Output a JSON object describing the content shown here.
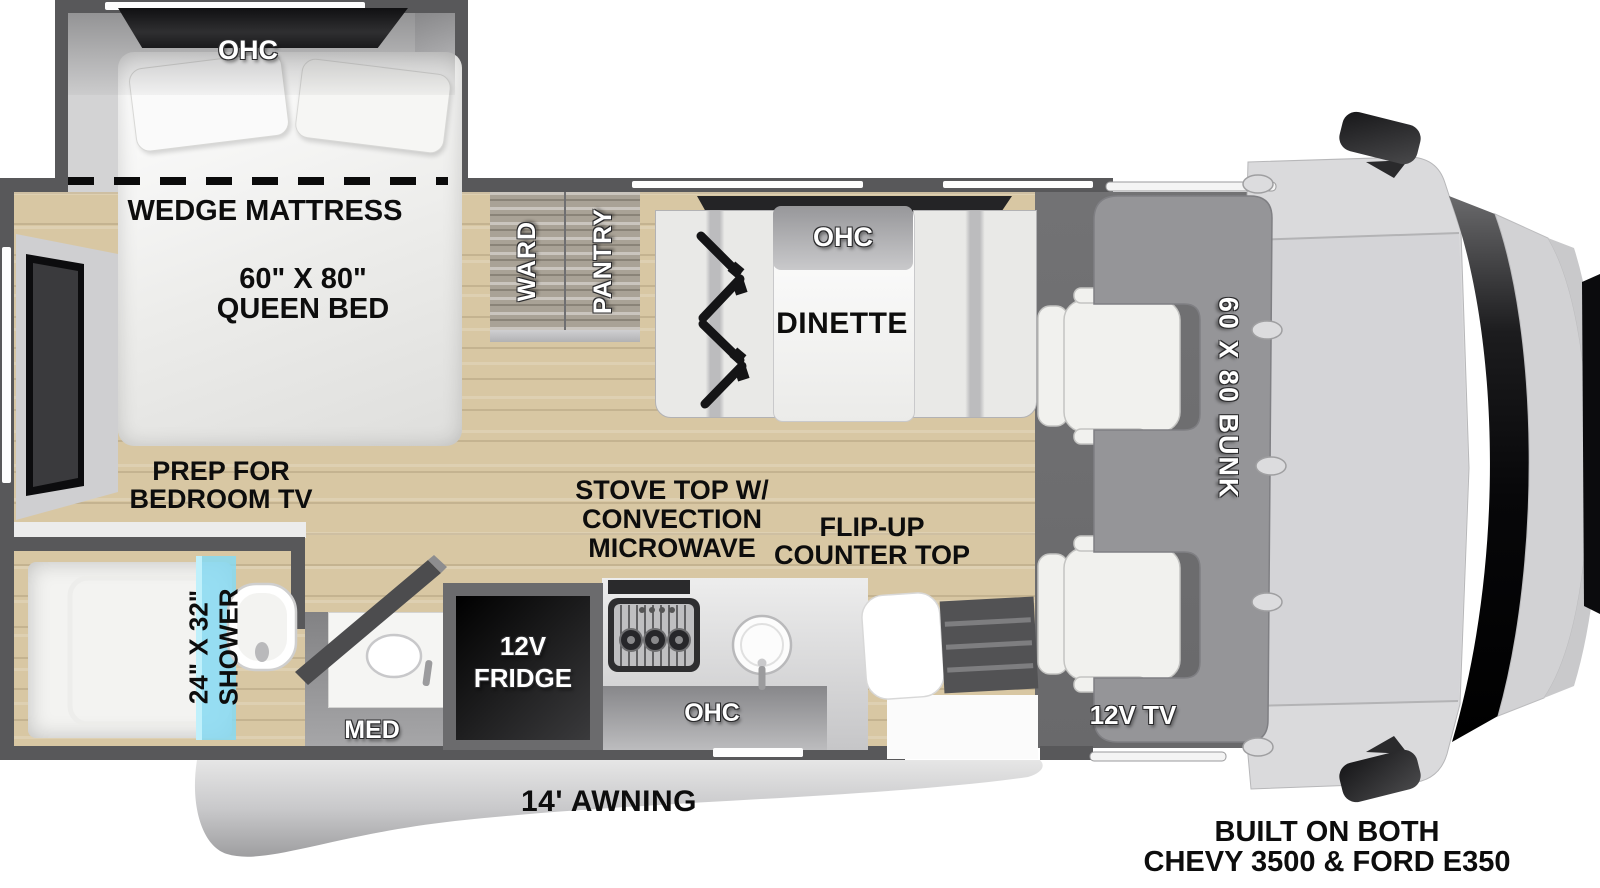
{
  "plan": {
    "bedroom": {
      "ohc": "OHC",
      "wedge_mattress": "WEDGE MATTRESS",
      "bed_size": "60\" X 80\"",
      "bed_type": "QUEEN BED",
      "tv_prep_line1": "PREP FOR",
      "tv_prep_line2": "BEDROOM TV"
    },
    "storage": {
      "ward": "WARD",
      "pantry": "PANTRY"
    },
    "dinette": {
      "label": "DINETTE",
      "ohc": "OHC"
    },
    "bathroom": {
      "shower_size": "24\" X 32\"",
      "shower": "SHOWER",
      "med": "MED"
    },
    "kitchen": {
      "fridge_line1": "12V",
      "fridge_line2": "FRIDGE",
      "ohc": "OHC",
      "stove_line1": "STOVE TOP W/",
      "stove_line2": "CONVECTION",
      "stove_line3": "MICROWAVE",
      "counter_line1": "FLIP-UP",
      "counter_line2": "COUNTER TOP"
    },
    "cab": {
      "bunk": "60 X 80 BUNK",
      "tv": "12V TV"
    },
    "exterior": {
      "awning": "14' AWNING"
    },
    "footer": {
      "line1": "BUILT ON BOTH",
      "line2": "CHEVY 3500 & FORD E350"
    }
  },
  "colors": {
    "wall": "#58585a",
    "floor_wood": "#d8c7a5",
    "cab_floor": "#6e6e70",
    "bunk": "#959598",
    "shower_glass": "#86d9f2",
    "label_dark": "#0d0d0d",
    "label_light": "#ffffff"
  }
}
